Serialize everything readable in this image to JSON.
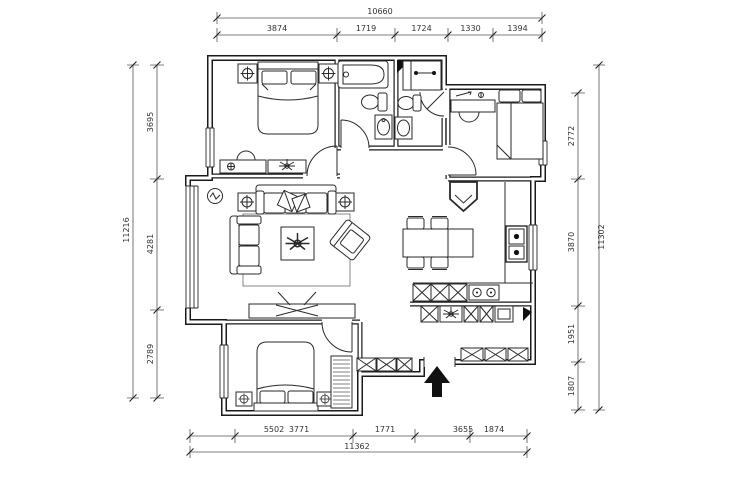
{
  "drawing": {
    "type": "apartment floor plan",
    "colors": {
      "ink": "#1a1a1a",
      "background": "#ffffff",
      "dim_line": "#555555",
      "dim_text": "#333333"
    },
    "icons": {
      "entry_arrow_icon": "▲",
      "lamp_icon": "⊕",
      "plant_icon": "✳",
      "tv_icon": "✕"
    }
  },
  "dimensions": {
    "top": {
      "total": "10660",
      "segments": [
        "3874",
        "1719",
        "1724",
        "1330",
        "1394"
      ]
    },
    "bottom": {
      "total": "11362",
      "segments": [
        "5502",
        "3771",
        "1771",
        "3655",
        "1874"
      ]
    },
    "left": {
      "total": "11216",
      "segments": [
        "3695",
        "4281",
        "2789"
      ]
    },
    "right": {
      "total": "11302",
      "segments": [
        "2772",
        "3870",
        "1951",
        "1807"
      ]
    }
  }
}
